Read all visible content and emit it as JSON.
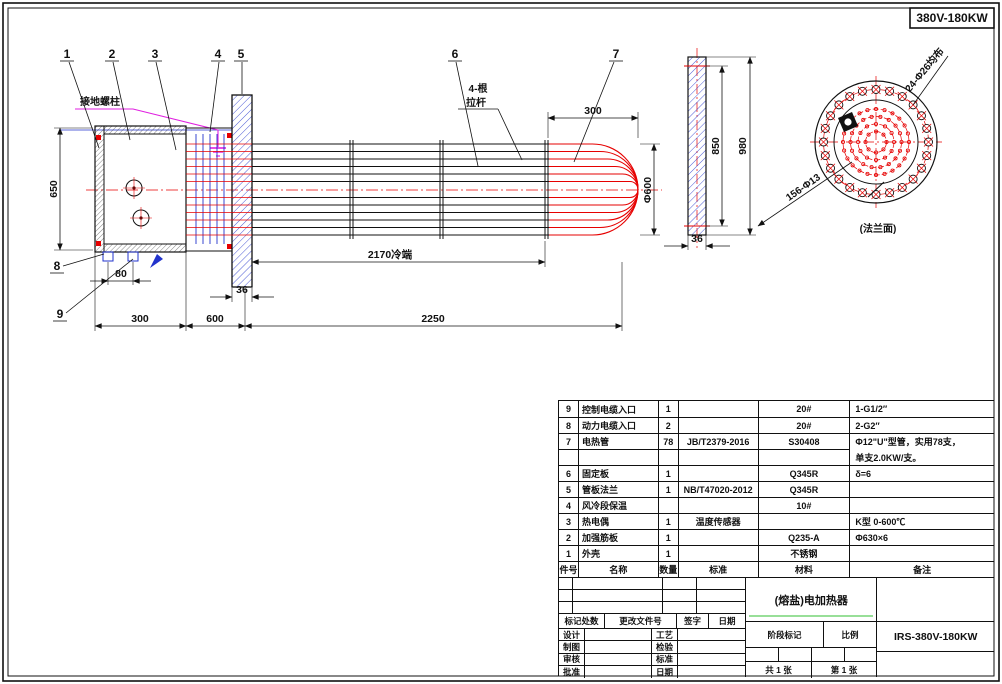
{
  "corner_label": "380V-180KW",
  "balloons": [
    "1",
    "2",
    "3",
    "4",
    "5",
    "6",
    "7",
    "8",
    "9"
  ],
  "dims": {
    "left_height": "650",
    "box_width": "300",
    "cold_shell": "600",
    "bundle": "2250",
    "plate_thk": "36",
    "cold_len": "2170冷端",
    "entry_pitch": "80",
    "bend_len": "300",
    "bundle_dia": "Φ600",
    "flange_rf": "850",
    "flange_od": "980",
    "flange_thk": "36"
  },
  "labels": {
    "ground": "接地螺柱",
    "tie_rod_l1": "4-根",
    "tie_rod_l2": "拉杆",
    "flange_face": "(法兰面)",
    "bolt_note": "24-Φ26均布",
    "tube_note": "156-Φ13"
  },
  "parts": {
    "headers": [
      "件号",
      "名称",
      "数量",
      "标准",
      "材料",
      "备注"
    ],
    "rows": [
      [
        "9",
        "控制电缆入口",
        "1",
        "",
        "20#",
        "1-G1/2″"
      ],
      [
        "8",
        "动力电缆入口",
        "2",
        "",
        "20#",
        "2-G2″"
      ],
      [
        "7",
        "电热管",
        "78",
        "JB/T2379-2016",
        "S30408",
        "Φ12\"U\"型管，实用78支，"
      ],
      [
        "",
        "",
        "",
        "",
        "",
        "单支2.0KW/支。"
      ],
      [
        "6",
        "固定板",
        "1",
        "",
        "Q345R",
        "δ=6"
      ],
      [
        "5",
        "管板法兰",
        "1",
        "NB/T47020-2012",
        "Q345R",
        ""
      ],
      [
        "4",
        "风冷段保温",
        "",
        "",
        "10#",
        ""
      ],
      [
        "3",
        "热电偶",
        "1",
        "温度传感器",
        "",
        "K型 0-600℃"
      ],
      [
        "2",
        "加强筋板",
        "1",
        "",
        "Q235-A",
        "Φ630×6"
      ],
      [
        "1",
        "外壳",
        "1",
        "",
        "不锈钢",
        ""
      ]
    ]
  },
  "titleblock": {
    "product_name": "(熔盐)电加热器",
    "drawing_no": "IRS-380V-180KW",
    "revision_header": [
      "标记处数",
      "更改文件号",
      "签字",
      "日期"
    ],
    "left_labels": [
      "设计",
      "制图",
      "审核",
      "批准"
    ],
    "mid_labels": [
      "工艺",
      "检验",
      "标准",
      "日期"
    ],
    "stage_label": "阶段标记",
    "scale_label": "比例",
    "sheet_total": "共 1 张",
    "sheet_no": "第 1 张"
  },
  "colors": {
    "red": "#e60000",
    "blue": "#2233cc",
    "magenta": "#e020e0",
    "green": "#98df98",
    "black": "#111111"
  }
}
